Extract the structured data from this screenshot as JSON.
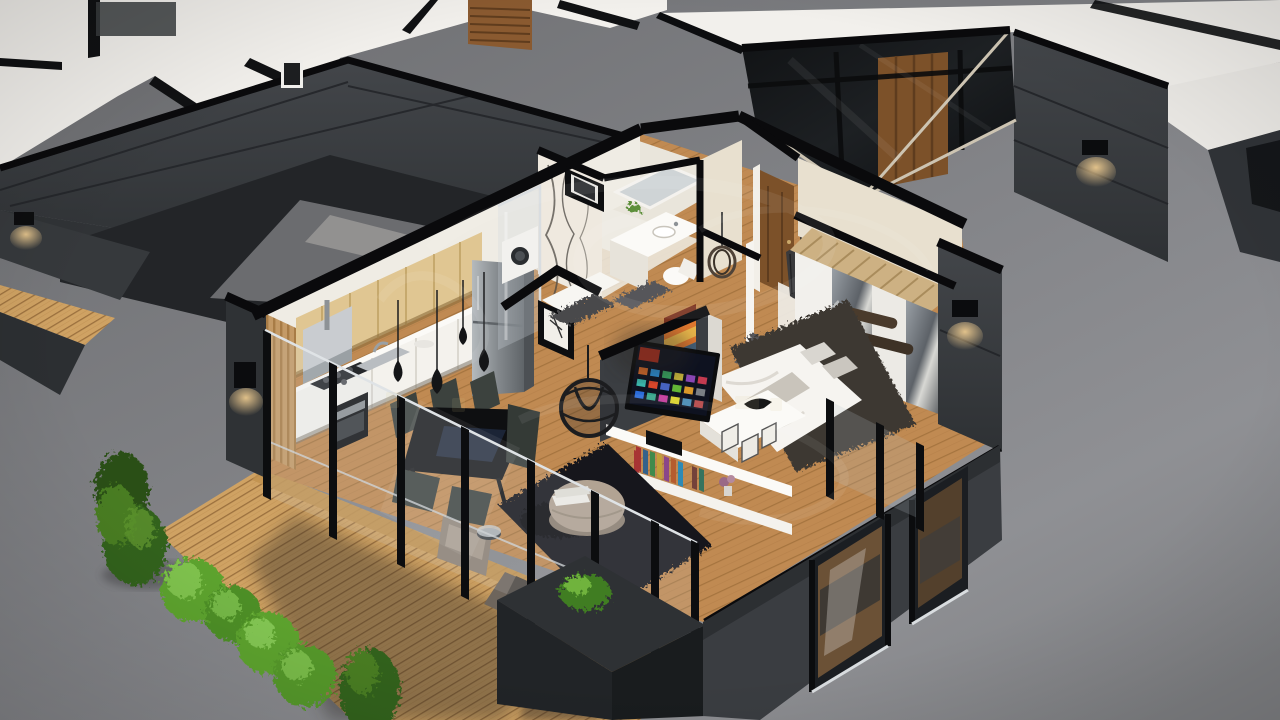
{
  "scene": {
    "kind": "3d-apartment-cutaway-render",
    "view": "isometric dollhouse floor plan, roof removed, walls section-cut in black",
    "units_visible": [
      "main-apartment",
      "neighbor-unit-top-left",
      "neighbor-unit-top-right"
    ],
    "rooms": [
      {
        "name": "kitchen",
        "features": [
          "wood-upper-cabinets",
          "range-hood",
          "gas-cooktop",
          "oven",
          "sink",
          "refrigerator",
          "coffee-machine"
        ]
      },
      {
        "name": "dining-area",
        "features": [
          "black-dining-table",
          "six-dark-chairs",
          "teardrop-pendant-lamps"
        ]
      },
      {
        "name": "living-area",
        "features": [
          "black-shag-rug",
          "round-taupe-pouf",
          "book-stack",
          "taupe-armchair",
          "rattan-sphere-pendant",
          "tv-media-wall",
          "smart-tv",
          "white-console-with-books",
          "striped-artwork"
        ]
      },
      {
        "name": "bathroom",
        "features": [
          "marble-feature-wall",
          "glass-shower",
          "vanity-with-mirror",
          "toilet",
          "washing-machine",
          "black-framed-window",
          "leaning-framed-art",
          "bath-mats"
        ]
      },
      {
        "name": "hallway",
        "features": [
          "wood-entry-door",
          "white-open-door",
          "basket-pendant",
          "fringe-pendant",
          "runner-rug"
        ]
      },
      {
        "name": "bedroom",
        "features": [
          "double-bed-white-linen",
          "foot-bench-with-frames",
          "bird-figurine",
          "mirrored-wardrobe",
          "wood-slat-canopy",
          "dark-rug",
          "facade-sconce"
        ]
      },
      {
        "name": "balcony-terrace",
        "features": [
          "glass-balustrade",
          "black-mullions",
          "wood-deck",
          "charcoal-planters",
          "outdoor-lounge-cushions",
          "green-bush"
        ]
      }
    ],
    "landscaping": [
      "tall-conifer",
      "row-of-round-bushes",
      "small-conifer",
      "deck-shadows"
    ],
    "watermark": {
      "present": true,
      "style": "faint cursive studio logo swirl",
      "opacity": 0.07
    }
  },
  "palette": {
    "bg_top": "#6b6c6f",
    "bg_mid": "#848589",
    "bg_light": "#8f9094",
    "cut_black": "#0a0a0c",
    "wall_dark_face": "#3a3d41",
    "wall_dark_deep": "#26282b",
    "wall_dark_side": "#2e3134",
    "slab_white": "#f2f0ec",
    "wall_white": "#efece4",
    "wall_cream": "#e8e0cf",
    "floor_wood": "#c08a52",
    "floor_seam": "#9c6c38",
    "deck_wood": "#cfa263",
    "deck_seam": "#8f6434",
    "kitchen_wood": "#e0c692",
    "counter_white": "#f4f2ed",
    "steel": "#9aa0a4",
    "glass_frame": "#c9ced2",
    "glass_dark": "#17191c",
    "rug_living": "#17181b",
    "rug_bedroom": "#3e3933",
    "pouf_taupe": "#b2a393",
    "bed_linen": "#f6f4f0",
    "pillow_gray": "#d9d6d0",
    "table_black": "#0e0f11",
    "chair_dark": "#3c423e",
    "pendant_black": "#141517",
    "door_wood": "#7c5129",
    "door_wood_light": "#95663a",
    "green_bright": "#5da32f",
    "green_dark": "#33621a",
    "green_deep": "#2a4f14",
    "warm_glow": "#ffd998",
    "tv_bg": "#0e1220",
    "art_orange": "#e0782f"
  }
}
